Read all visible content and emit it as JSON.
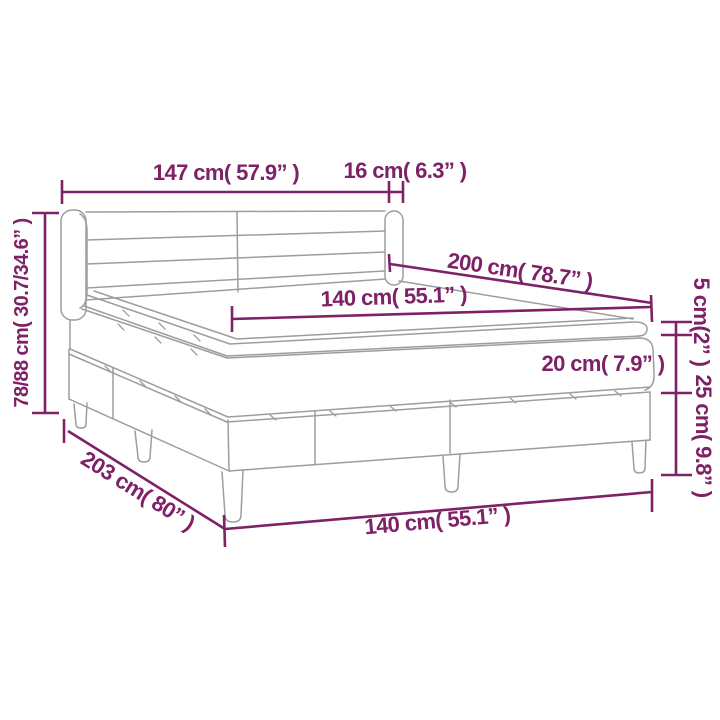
{
  "page": {
    "background": "#FFFFFF"
  },
  "diagram": {
    "subject": "box spring bed with headboard, mattress and topper",
    "accent_color": "#7E2167",
    "line_color": "#9D9D9D",
    "labels": {
      "headboard_width": "147 cm( 57.9” )",
      "headboard_side_depth": "16 cm( 6.3” )",
      "overall_height": "78/88 cm( 30.7/34.6” )",
      "bed_length": "200 cm( 78.7” )",
      "mattress_width": "140 cm( 55.1” )",
      "topper_height": "5 cm(2” )",
      "mattress_height": "20 cm( 7.9” )",
      "base_height": "25 cm( 9.8” )",
      "base_length": "203 cm( 80” )",
      "base_width": "140 cm( 55.1” )"
    }
  }
}
